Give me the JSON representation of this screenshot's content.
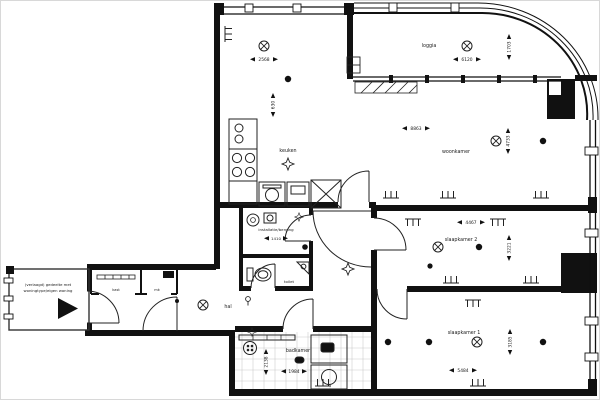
{
  "floorplan": {
    "rooms": {
      "loggia": {
        "name": "loggia",
        "width": "6120",
        "depth": "1703"
      },
      "woonkamer": {
        "name": "woonkamer",
        "width": "8863",
        "depth": "4733",
        "nook_width": "2568",
        "nook_depth": "630"
      },
      "keuken": {
        "name": "keuken"
      },
      "berging": {
        "name": "installatie/berging",
        "width": "1410"
      },
      "toilet": {
        "name": "toilet"
      },
      "hal": {
        "name": "hal"
      },
      "badkamer": {
        "name": "badkamer",
        "width": "1984",
        "depth": "2138"
      },
      "slaapkamer2": {
        "name": "slaapkamer 2",
        "width": "4467",
        "depth": "3221"
      },
      "slaapkamer1": {
        "name": "slaapkamer 1",
        "width": "5484",
        "depth": "3185"
      },
      "kast": {
        "name": "kast"
      },
      "meterkast": {
        "name": "mk"
      }
    },
    "annotations": {
      "galerij_note_line1": "(verlaagd) gedeelte met",
      "galerij_note_line2": "woningtype/eigen woning"
    },
    "colors": {
      "wall": "#111111",
      "thin_line": "#2a2a2a",
      "background": "#ffffff",
      "tile_line": "#cccccc"
    }
  }
}
